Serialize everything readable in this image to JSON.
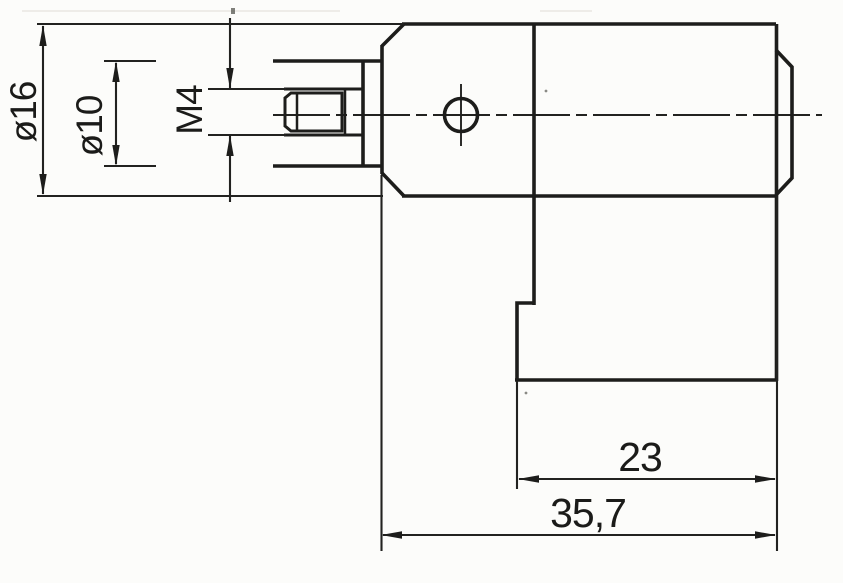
{
  "document": {
    "type": "technical-drawing",
    "description": "Dimensioned side view of a cylindrical sensor body with M4 threaded stud, flange and lower connector block",
    "colors": {
      "line": "#1d1d1b",
      "thin_line": "#222220",
      "background": "#fcfcfa"
    },
    "labels": {
      "dia_outer": "ø16",
      "dia_inner": "ø10",
      "thread": "M4",
      "len_front": "23",
      "len_total": "35,7"
    }
  }
}
